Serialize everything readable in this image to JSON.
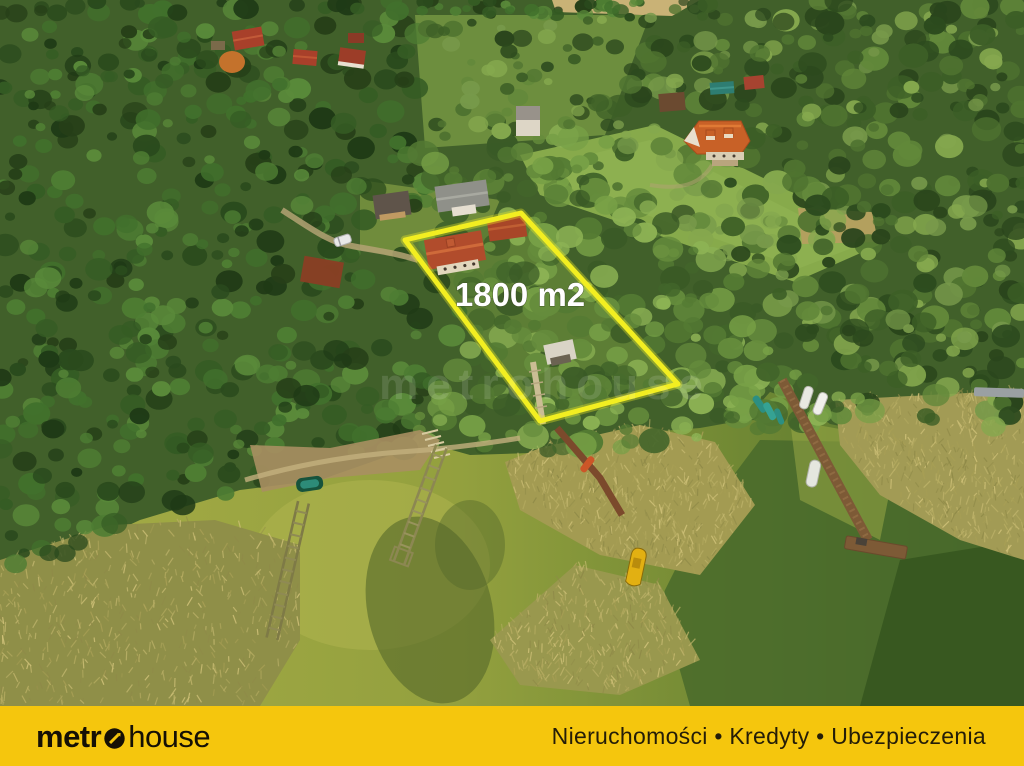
{
  "photo": {
    "description": "aerial-photo-of-lakefront-forest-plot",
    "area_label": "1800 m2",
    "area_label_color": "#ffffff",
    "plot_outline_color": "#f2ee21",
    "watermark_text": "metrohouse"
  },
  "footer": {
    "background_color": "#f5c60d",
    "logo_text_bold": "metr",
    "logo_o_icon": "circle-arrow-icon",
    "logo_text_light": "house",
    "logo_color": "#151005",
    "services": "Nieruchomości • Kredyty • Ubezpieczenia",
    "services_color": "#241d08"
  }
}
